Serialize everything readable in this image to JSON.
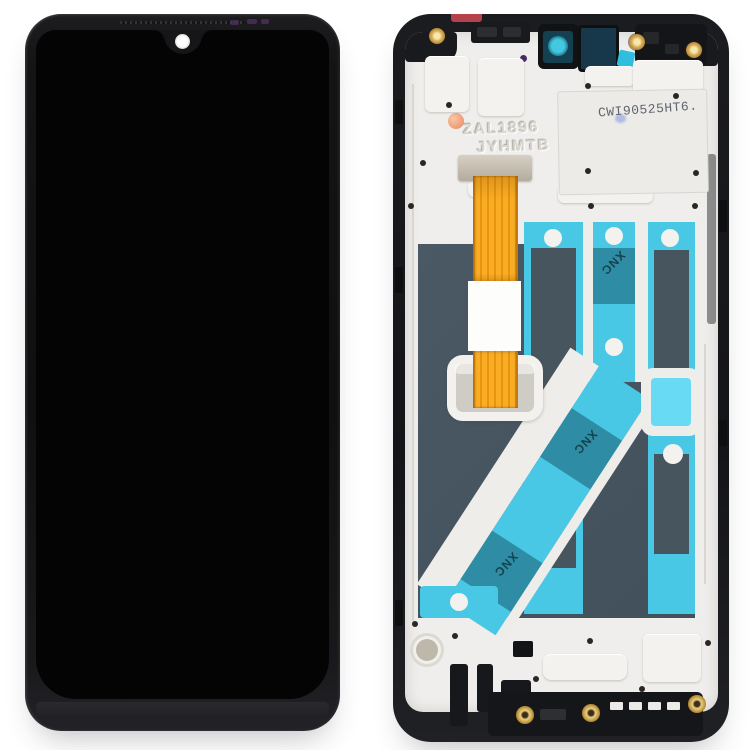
{
  "photo": {
    "subject": "Phone LCD screen and digitizer full assembly with frame, front and back views",
    "background_color": "#ffffff",
    "front_view": "Assembled black display with teardrop notch and front camera hole",
    "back_view": "Frame rear with metal backplate, orange flex cable and cyan adhesive tapes"
  },
  "markings": {
    "printed_code": "CWI90525HT6.",
    "stamped_line1": "ZAL1896",
    "stamped_line2": "JYHMTB",
    "tape_label": "XNC"
  },
  "colors": {
    "frame_black": "#17181a",
    "plate_white": "#efeeec",
    "lcd_back_slate": "#475561",
    "tape_cyan": "#49c8e6",
    "tape_teal": "#2e8da4",
    "tape_bright_cyan": "#68daf3",
    "flex_orange": "#f3a019",
    "screw_gold": "#c79a3e",
    "adhesive_dot_orange": "#ef9a74",
    "sticker_red": "#b5424a",
    "camera_lens_teal": "#44c8e0"
  }
}
